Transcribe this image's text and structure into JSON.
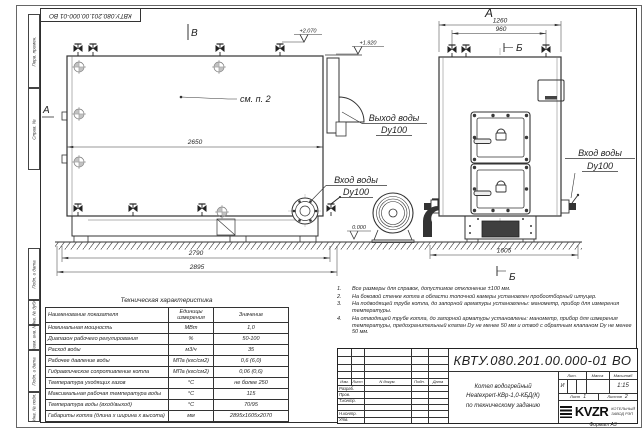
{
  "style": {
    "line": "#333333",
    "paper": "#ffffff",
    "ink": "#1f1f1f"
  },
  "sheet": {
    "doc_number": "КВТУ.080.201.00.000-01 ВО",
    "format_note": "Формат А3",
    "margin_labels": [
      "Перв. примен.",
      "Справ. №",
      "Подп. и дата",
      "Инв. № дубл.",
      "Взам. инв. №",
      "Подп. и дата",
      "Инв. № подл."
    ]
  },
  "views": {
    "marker_v": "В",
    "marker_a": "А",
    "marker_b": "Б",
    "see_note": "см. п. 2"
  },
  "dimensions": {
    "side_width_inner": "2650",
    "side_width_frame": "2790",
    "side_width_total": "2895",
    "front_width_total": "1260",
    "front_valve_span": "960",
    "front_base_width": "1605"
  },
  "elevations": {
    "valve_top": "+2.070",
    "boiler_top": "+1.920",
    "ground": "0.000"
  },
  "ports": {
    "outlet_line1": "Выход воды",
    "outlet_line2": "Dy100",
    "inlet_line1": "Вход воды",
    "inlet_line2": "Dy100"
  },
  "tech_table": {
    "title": "Техническая характеристика",
    "headers": [
      "Наименование показателя",
      "Единицы измерения",
      "Значение"
    ],
    "rows": [
      {
        "name": "Номинальная мощность",
        "unit": "МВт",
        "value": "1,0"
      },
      {
        "name": "Диапазон рабочего регулирования",
        "unit": "%",
        "value": "50-100"
      },
      {
        "name": "Расход воды",
        "unit": "м3/ч",
        "value": "35"
      },
      {
        "name": "Рабочее давление воды",
        "unit": "МПа (кгс/см2)",
        "value": "0,6 (6,0)"
      },
      {
        "name": "Гидравлическое сопротивление котла",
        "unit": "МПа (кгс/см2)",
        "value": "0,06 (0,6)"
      },
      {
        "name": "Температура уходящих газов",
        "unit": "°С",
        "value": "не более 250"
      },
      {
        "name": "Максимальная рабочая температура воды",
        "unit": "°С",
        "value": "115"
      },
      {
        "name": "Температура воды (вход/выход)",
        "unit": "°С",
        "value": "70/95"
      },
      {
        "name": "Габариты котла (длина х ширина х высота)",
        "unit": "мм",
        "value": "2895х1605х2070"
      }
    ]
  },
  "notes": [
    {
      "num": "1.",
      "text": "Все размеры для справок, допустимое отклонение ±100 мм."
    },
    {
      "num": "2.",
      "text": "На боковой стенке котла в области топочной камеры установлен пробоотборный штуцер."
    },
    {
      "num": "3.",
      "text": "На подводящей трубе котла, до запорной арматуры установлены: манометр, прибор для измерения температуры."
    },
    {
      "num": "4.",
      "text": "На отводящей трубе котла, до запорной арматуры установлены: манометр, прибор для измерения температуры, предохранительный клапан Dу не менее 50 мм и отвод с обратным клапаном Dу не менее 50 мм."
    }
  ],
  "title_block": {
    "header_cols": [
      "Изм.",
      "Лист",
      "N докум.",
      "Подп.",
      "Дата"
    ],
    "sign_rows": [
      "Разраб.",
      "Пров.",
      "Т.контр.",
      "",
      "Н.контр.",
      "Утв."
    ],
    "product_name": [
      "Котел водогрейный",
      "Heatexpert-КВр-1,0-КБД(К)",
      "по техническому заданию"
    ],
    "liter_label": "Лит.",
    "liter_value": "И",
    "mass_label": "Масса",
    "scale_label": "Масштаб",
    "scale_value": "1:15",
    "sheet_label": "Лист",
    "sheet_value": "1",
    "sheets_label": "Листов",
    "sheets_value": "2",
    "logo_text": "KVZR",
    "company": [
      "КОТЕЛЬНЫЙ",
      "ЗАВОД РЭП"
    ]
  }
}
